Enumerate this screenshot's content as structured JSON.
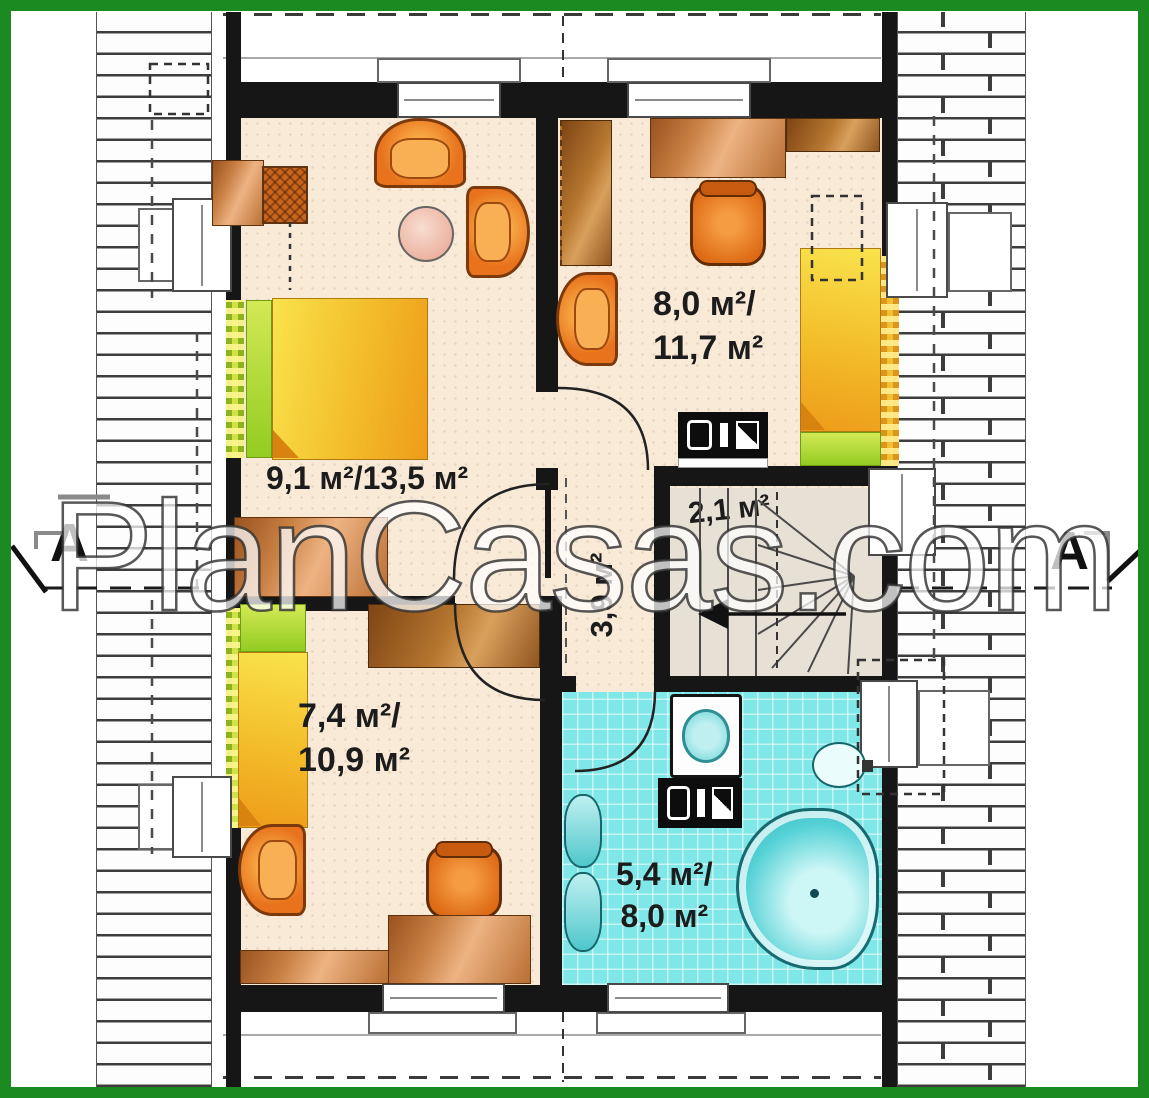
{
  "plan": {
    "watermark": "PlanCasas.com",
    "section_marker_left": "A",
    "section_marker_right": "A"
  },
  "rooms": [
    {
      "name": "bedroom-top-left",
      "area_label": "9,1 м²/13,5 м²"
    },
    {
      "name": "bedroom-top-right",
      "area_line1": "8,0 м²/",
      "area_line2": "11,7 м²"
    },
    {
      "name": "staircase",
      "area_label": "2,1 м²"
    },
    {
      "name": "hallway",
      "area_label": "3,9 м²"
    },
    {
      "name": "bedroom-bottom-left",
      "area_line1": "7,4 м²/",
      "area_line2": "10,9 м²"
    },
    {
      "name": "bathroom",
      "area_line1": "5,4 м²/",
      "area_line2": "8,0 м²"
    }
  ],
  "colors": {
    "frame_green": "#1b8a20",
    "wall_black": "#161616",
    "floor_cream": "#f9e9d7",
    "bathroom_cyan": "#7fe7e8",
    "furniture_orange": "#e8731c",
    "bed_yellow": "#f3bc2a",
    "pillow_green": "#93cc22",
    "stair_grey": "#e6e1d4"
  }
}
